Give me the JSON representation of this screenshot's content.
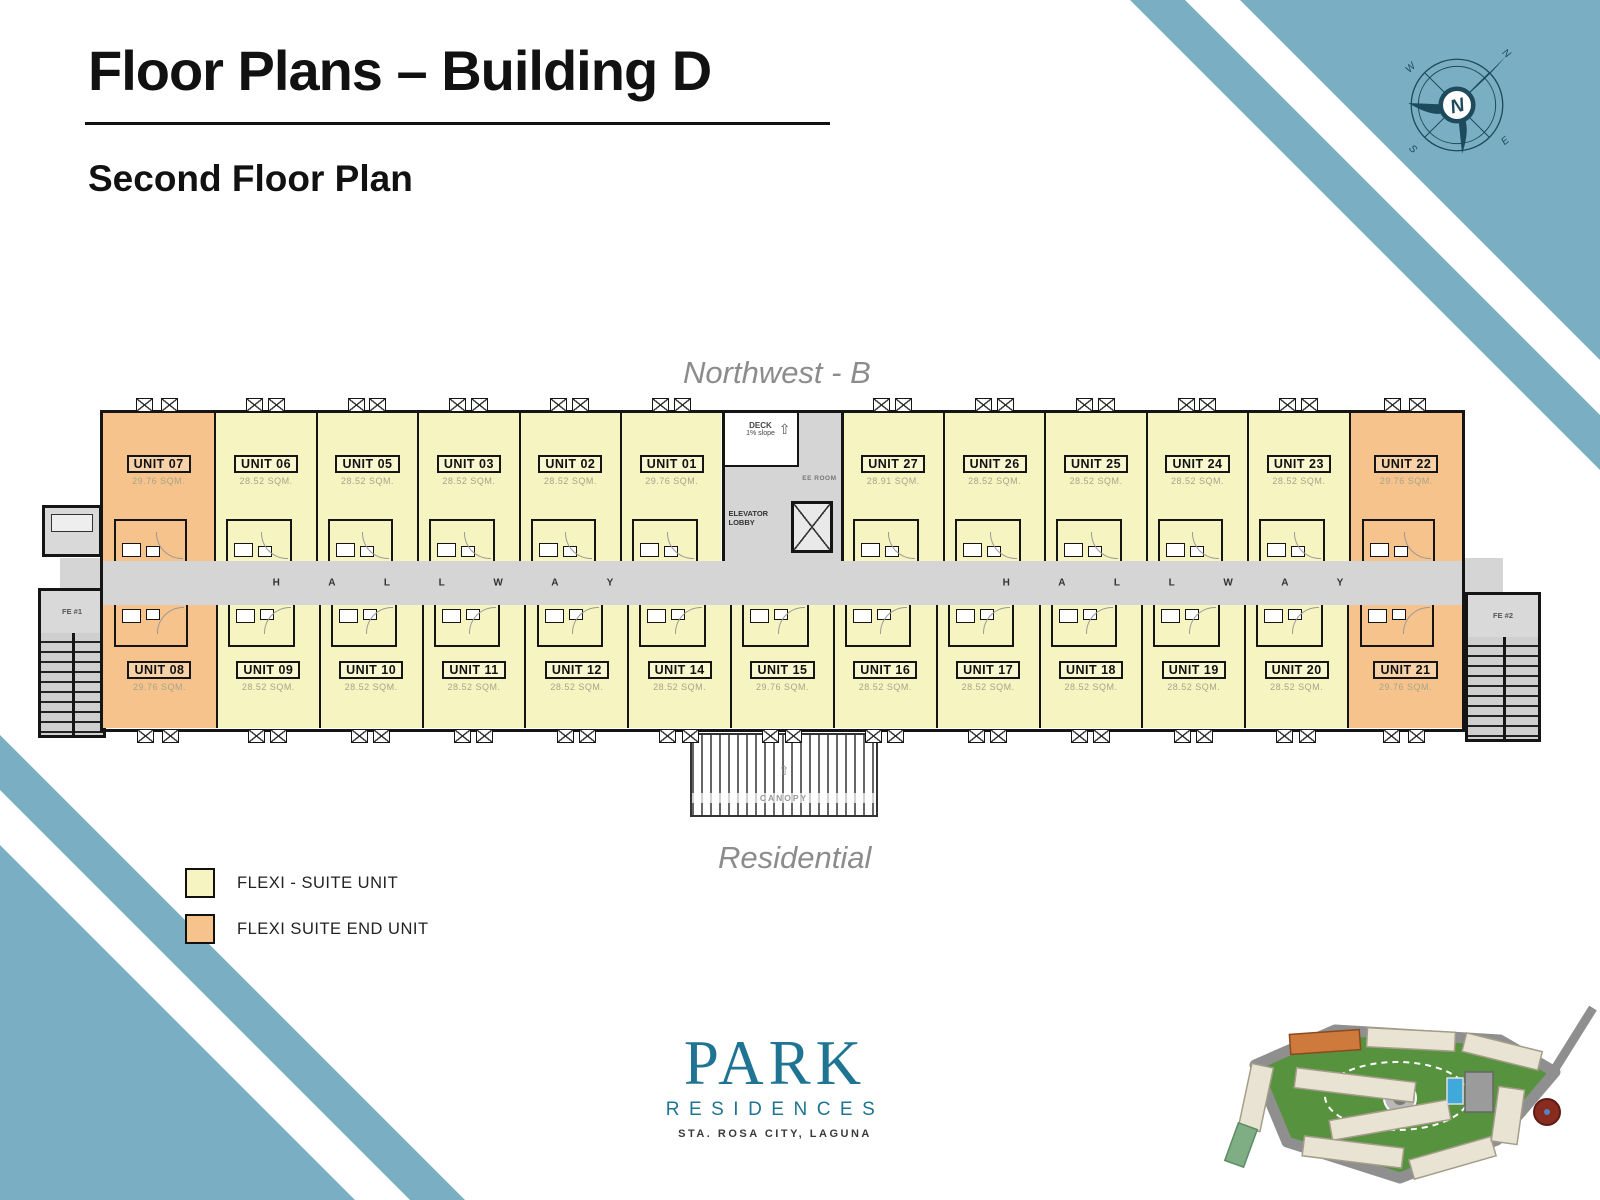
{
  "slide": {
    "title": "Floor Plans – Building D",
    "subtitle": "Second Floor Plan",
    "top_label": "Northwest - B",
    "bottom_label": "Residential"
  },
  "colors": {
    "flexi_suite": "#F6F4C1",
    "flexi_end": "#F5C38B",
    "hallway_gray": "#D5D5D5",
    "band_teal": "#7AAFC3",
    "compass_navy": "#1D4A5C",
    "logo_teal": "#1E7492"
  },
  "floor_plan": {
    "hallway_label": "H A L L W A Y",
    "core": {
      "deck_line1": "DECK",
      "deck_line2": "1% slope",
      "ee_room": "EE ROOM",
      "elevator_line1": "ELEVATOR",
      "elevator_line2": "LOBBY"
    },
    "stair_left": "FE #1",
    "stair_right": "FE #2",
    "canopy": "CANOPY",
    "top_left_units": [
      {
        "id": "UNIT 07",
        "area": "29.76 SQM.",
        "type": "end"
      },
      {
        "id": "UNIT 06",
        "area": "28.52 SQM.",
        "type": "std"
      },
      {
        "id": "UNIT 05",
        "area": "28.52 SQM.",
        "type": "std"
      },
      {
        "id": "UNIT 03",
        "area": "28.52 SQM.",
        "type": "std"
      },
      {
        "id": "UNIT 02",
        "area": "28.52 SQM.",
        "type": "std"
      },
      {
        "id": "UNIT 01",
        "area": "29.76 SQM.",
        "type": "std"
      }
    ],
    "top_right_units": [
      {
        "id": "UNIT 27",
        "area": "28.91 SQM.",
        "type": "std"
      },
      {
        "id": "UNIT 26",
        "area": "28.52 SQM.",
        "type": "std"
      },
      {
        "id": "UNIT 25",
        "area": "28.52 SQM.",
        "type": "std"
      },
      {
        "id": "UNIT 24",
        "area": "28.52 SQM.",
        "type": "std"
      },
      {
        "id": "UNIT 23",
        "area": "28.52 SQM.",
        "type": "std"
      },
      {
        "id": "UNIT 22",
        "area": "29.76 SQM.",
        "type": "end"
      }
    ],
    "bottom_units": [
      {
        "id": "UNIT 08",
        "area": "29.76 SQM.",
        "type": "end"
      },
      {
        "id": "UNIT 09",
        "area": "28.52 SQM.",
        "type": "std"
      },
      {
        "id": "UNIT 10",
        "area": "28.52 SQM.",
        "type": "std"
      },
      {
        "id": "UNIT 11",
        "area": "28.52 SQM.",
        "type": "std"
      },
      {
        "id": "UNIT 12",
        "area": "28.52 SQM.",
        "type": "std"
      },
      {
        "id": "UNIT 14",
        "area": "28.52 SQM.",
        "type": "std"
      },
      {
        "id": "UNIT 15",
        "area": "29.76 SQM.",
        "type": "std"
      },
      {
        "id": "UNIT 16",
        "area": "28.52 SQM.",
        "type": "std"
      },
      {
        "id": "UNIT 17",
        "area": "28.52 SQM.",
        "type": "std"
      },
      {
        "id": "UNIT 18",
        "area": "28.52 SQM.",
        "type": "std"
      },
      {
        "id": "UNIT 19",
        "area": "28.52 SQM.",
        "type": "std"
      },
      {
        "id": "UNIT 20",
        "area": "28.52 SQM.",
        "type": "std"
      },
      {
        "id": "UNIT 21",
        "area": "29.76 SQM.",
        "type": "end"
      }
    ]
  },
  "legend": {
    "items": [
      {
        "label": "FLEXI - SUITE UNIT",
        "type": "std"
      },
      {
        "label": "FLEXI SUITE END UNIT",
        "type": "end"
      }
    ]
  },
  "logo": {
    "name": "PARK",
    "line2": "RESIDENCES",
    "line3": "STA. ROSA CITY, LAGUNA"
  },
  "compass": {
    "n": "N",
    "e": "E",
    "s": "S",
    "w": "W"
  }
}
